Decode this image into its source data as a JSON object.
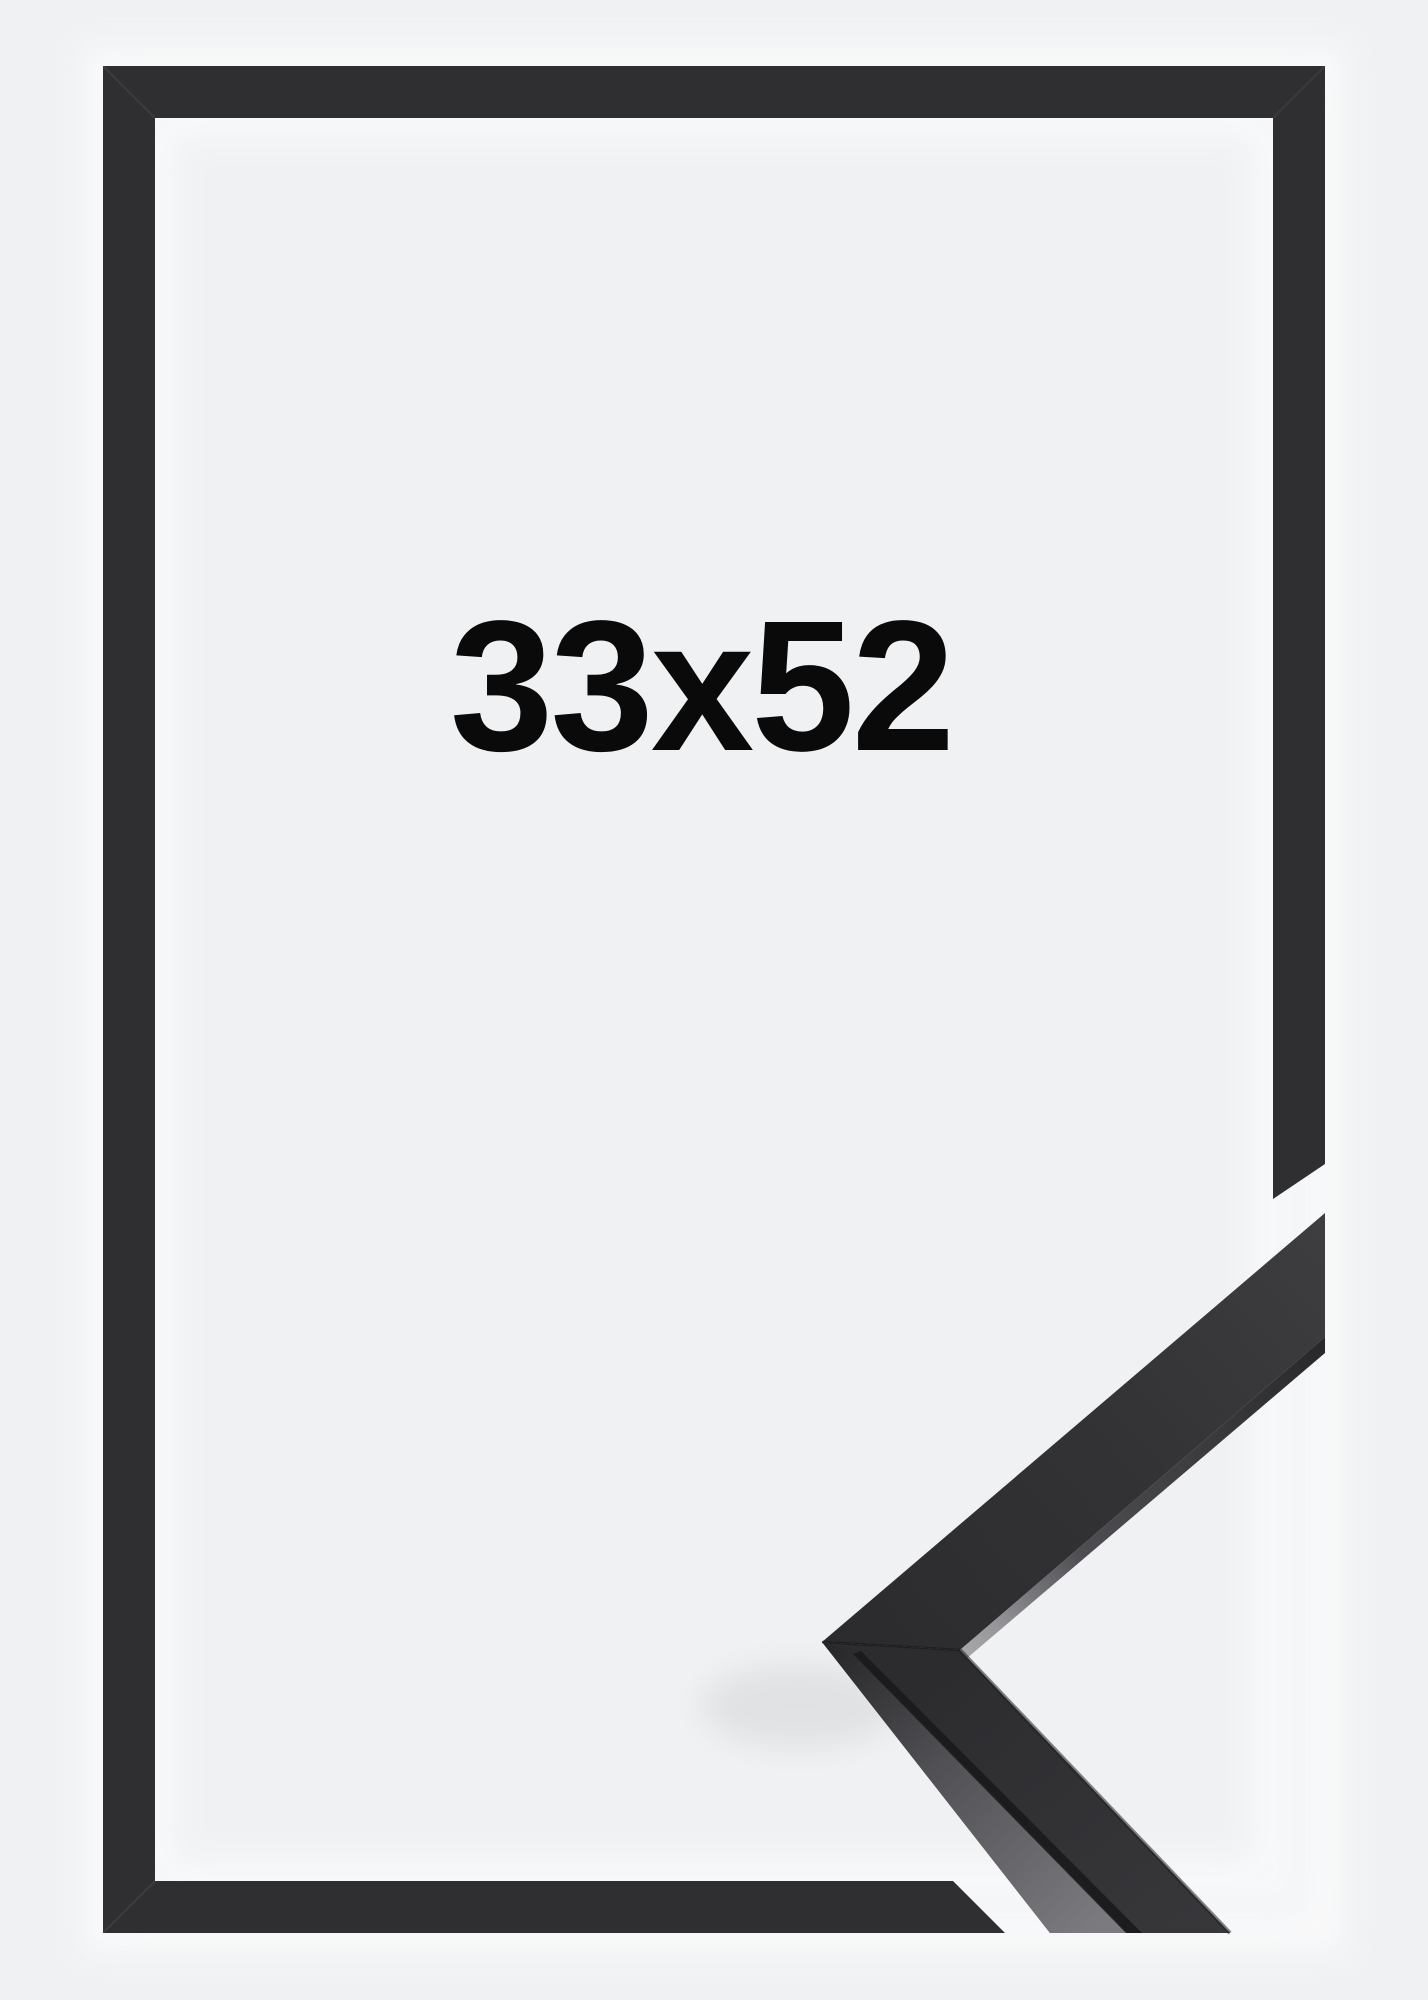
{
  "product": {
    "size_label": "33x52",
    "description": "Black picture frame shown flat from the front with a mitered 3D corner profile sample in the lower right",
    "colors": {
      "background": "#f0f1f2",
      "frame": "#2f2f31",
      "label_text": "#0a0a0b",
      "corner_top_face_near": "#2b2b2d",
      "corner_top_face_far": "#3e3e41",
      "corner_side_face": "#76767a",
      "seam": "#1a1a1c",
      "halo": "#fafbfc"
    }
  }
}
